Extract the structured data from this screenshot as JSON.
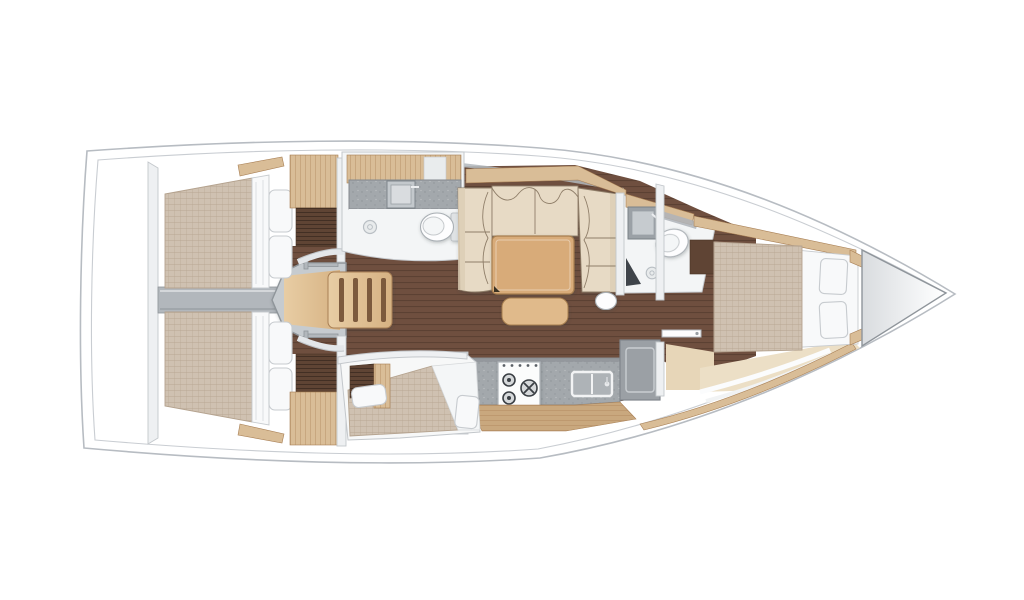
{
  "canvas": {
    "width": 1024,
    "height": 600,
    "background": "#ffffff"
  },
  "diagram": {
    "type": "floor-plan",
    "subject": "sailing-yacht-interior",
    "view": "top-down",
    "orientation": "bow-right",
    "elements": [
      "hull-outline",
      "deck-inner-line",
      "bow-anchor-locker",
      "port-aft-cabin-double-berth",
      "starboard-aft-cabin-double-berth",
      "engine-compartment-beam",
      "companionway-stairs",
      "aft-head-sink",
      "aft-head-toilet",
      "aft-head-shower-drain",
      "salon-u-sofa",
      "salon-table",
      "salon-stool",
      "salon-pouf",
      "galley-counter",
      "galley-stove",
      "galley-sink",
      "fridge",
      "starboard-berth-cabin",
      "forward-head-sink",
      "forward-head-toilet",
      "forward-head-shower-drain",
      "forward-cabin-island-berth",
      "forward-cabin-steps",
      "wardrobe-tambour-cabinets"
    ]
  },
  "colors": {
    "hull_line": "#b7bcc2",
    "hull_inner_line": "#c9cdd2",
    "deck": "#ffffff",
    "floor": "#6f4f3f",
    "floor_line": "#5c4133",
    "wood": "#d9bd97",
    "wood_deep": "#c9a87e",
    "wood_line": "#a87f54",
    "stair_wood": "#d6b283",
    "stair_gap": "#7c5a3d",
    "dark_wood": "#5f4434",
    "mattress": "#cfc1b1",
    "mattress_line": "#b4a28e",
    "bedding": "#f8f9fa",
    "bedding_line": "#c7cbcf",
    "sofa": "#e7dac5",
    "sofa_shade": "#dccdb4",
    "sofa_line": "#8f7e69",
    "table": "#d8ab79",
    "stool": "#e0ba8b",
    "table_line": "#a67e4f",
    "counter": "#a3a8ac",
    "counter_line": "#84898e",
    "backsplash": "#8d9297",
    "fixture": "#fdfdfe",
    "fixture_line": "#a9afb4",
    "bath_floor": "#f3f5f6",
    "metal": "#b2b7bc",
    "metal_line": "#8f959a",
    "wall": "#eef0f2",
    "wall_line": "#c3c7cb",
    "dark_seat": "#3f444a",
    "fridge": "#9ba0a5",
    "step_beige": "#e7d6b8",
    "step_beige_light": "#ecdfc6",
    "bow_shade": "#d9dcdf",
    "burner": "#3a3f44"
  }
}
